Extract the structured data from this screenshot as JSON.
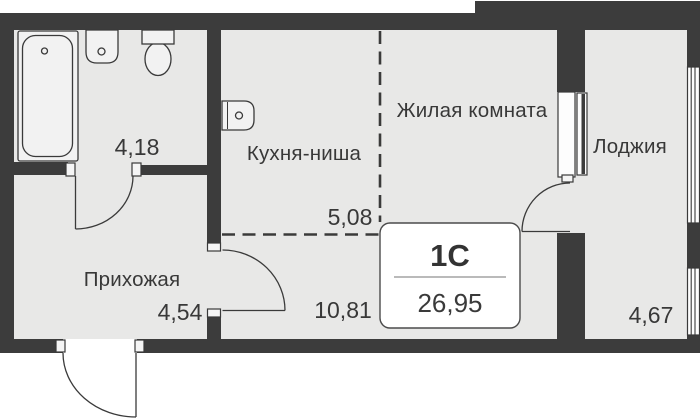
{
  "floorplan": {
    "unit_plate": {
      "type": "1С",
      "total_area": "26,95"
    },
    "rooms": {
      "living_room": {
        "label": "Жилая комната",
        "area": "10,81"
      },
      "kitchen_niche": {
        "label": "Кухня-ниша",
        "area": "5,08"
      },
      "hallway": {
        "label": "Прихожая",
        "area": "4,54"
      },
      "loggia": {
        "label": "Лоджия",
        "area": "4,67"
      },
      "bathroom": {
        "area": "4,18"
      }
    },
    "colors": {
      "wall": "#3c3c3c",
      "floor": "#e8e8e7",
      "line": "#3a3a3a",
      "background": "#ffffff",
      "text": "#383838"
    }
  }
}
